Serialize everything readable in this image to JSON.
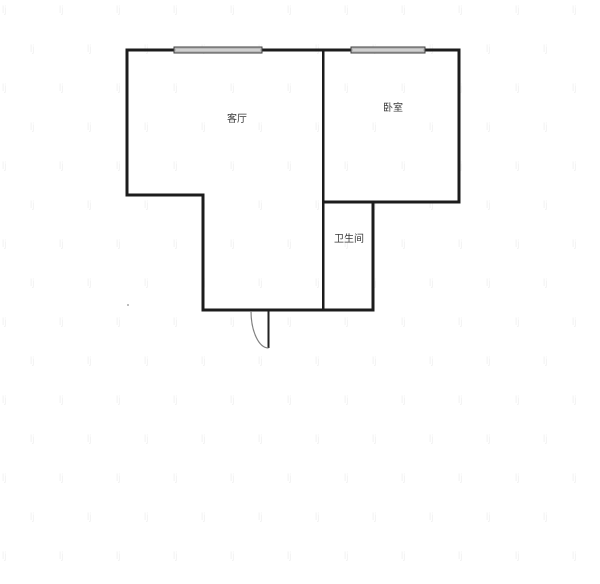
{
  "page": {
    "background": "#ffffff",
    "kind": "apartment-floor-plan"
  },
  "floorplan": {
    "rooms": {
      "living_room": {
        "label": "客厅"
      },
      "bedroom": {
        "label": "卧室"
      },
      "bathroom": {
        "label": "卫生间"
      }
    },
    "features": {
      "windows_count": 2,
      "entry_door": "bottom wall, quarter-circle swing"
    },
    "colors": {
      "wall": "#1c1c1c",
      "window_fill": "#b9b9b9",
      "window_border": "#3f3f3f",
      "window_center_line": "#e6e6e6",
      "door_leaf": "#222222",
      "door_arc": "#808080",
      "label_text": "#3a3a3a",
      "watermark": "#f1f1f1",
      "speck": "#a9a9a9"
    },
    "watermark": {
      "glyph": "lj"
    }
  }
}
